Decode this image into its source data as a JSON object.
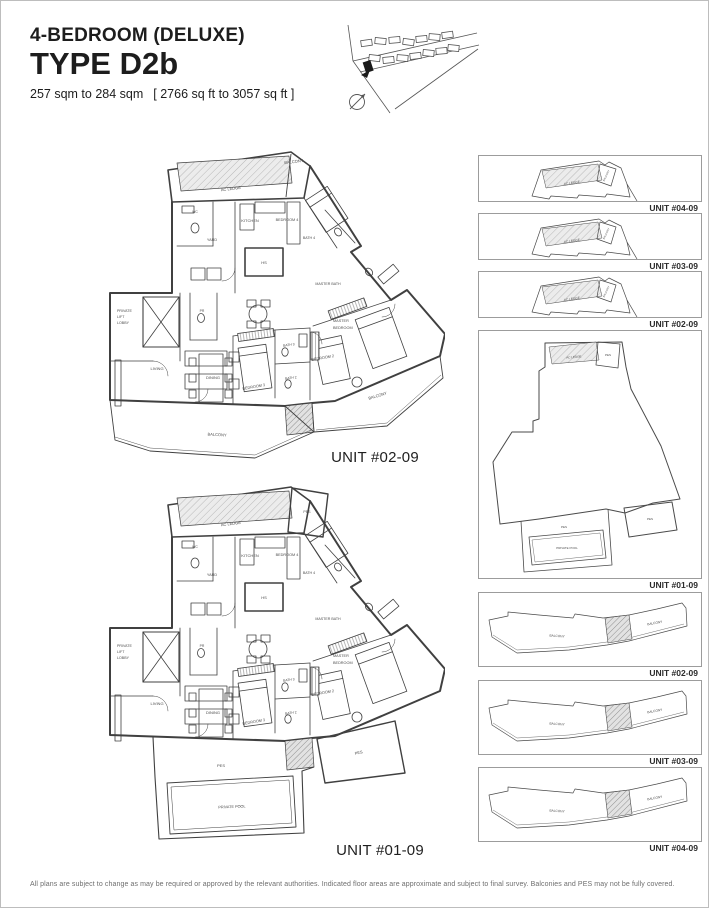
{
  "header": {
    "subtitle": "4-BEDROOM (DELUXE)",
    "title": "TYPE D2b",
    "area_metric": "257 sqm to 284 sqm",
    "area_imperial": "[ 2766 sq ft to 3057 sq ft ]"
  },
  "plan_upper": {
    "unit_label": "UNIT #02-09",
    "labels": {
      "balcony_top": "BALCONY",
      "ac_ledge": "AC LEDGE",
      "wc": "WC",
      "yard": "YARD",
      "kitchen": "KITCHEN",
      "hs": "HS",
      "bedroom4": "BEDROOM 4",
      "bath4": "BATH 4",
      "master_bath": "MASTER BATH",
      "lift_lobby": [
        "PRIVATE",
        "LIFT",
        "LOBBY"
      ],
      "pr": "PR",
      "living": "LIVING",
      "dining": "DINING",
      "bedroom3": "BEDROOM 3",
      "bath3": "BATH 3",
      "bedroom2": "BEDROOM 2",
      "bath2": "BATH 2",
      "master_bedroom": [
        "MASTER",
        "BEDROOM"
      ],
      "balcony_right": "BALCONY",
      "balcony_bottom": "BALCONY"
    }
  },
  "plan_lower": {
    "unit_label": "UNIT #01-09",
    "labels": {
      "pes_top": "PES",
      "ac_ledge": "AC LEDGE",
      "wc": "WC",
      "yard": "YARD",
      "kitchen": "KITCHEN",
      "hs": "HS",
      "bedroom4": "BEDROOM 4",
      "bath4": "BATH 4",
      "master_bath": "MASTER BATH",
      "lift_lobby": [
        "PRIVATE",
        "LIFT",
        "LOBBY"
      ],
      "pr": "PR",
      "living": "LIVING",
      "dining": "DINING",
      "bedroom3": "BEDROOM 3",
      "bath3": "BATH 3",
      "bedroom2": "BEDROOM 2",
      "bath2": "BATH 2",
      "master_bedroom": [
        "MASTER",
        "BEDROOM"
      ],
      "pes_right": "PES",
      "pes_bottom": "PES",
      "private_pool": "PRIVATE POOL"
    }
  },
  "key_plans_top": [
    {
      "unit_label": "UNIT #04-09",
      "ac_ledge": "AC LEDGE",
      "balcony": "BALCONY"
    },
    {
      "unit_label": "UNIT #03-09",
      "ac_ledge": "AC LEDGE",
      "balcony": "BALCONY"
    },
    {
      "unit_label": "UNIT #02-09",
      "ac_ledge": "AC LEDGE",
      "balcony": "BALCONY"
    }
  ],
  "key_plan_large": {
    "unit_label": "UNIT #01-09",
    "ac_ledge": "AC LEDGE",
    "pes_top": "PES",
    "pes_bottom": "PES",
    "private_pool": "PRIVATE POOL",
    "pes_right": "PES"
  },
  "key_plans_bottom": [
    {
      "unit_label": "UNIT #02-09",
      "balcony_left": "BALCONY",
      "balcony_right": "BALCONY"
    },
    {
      "unit_label": "UNIT #03-09",
      "balcony_left": "BALCONY",
      "balcony_right": "BALCONY"
    },
    {
      "unit_label": "UNIT #04-09",
      "balcony_left": "BALCONY",
      "balcony_right": "BALCONY"
    }
  ],
  "footer": {
    "disclaimer": "All plans are subject to change as may be required or approved by the relevant authorities. Indicated floor areas are approximate and subject to final survey. Balconies and PES may not be fully covered."
  }
}
